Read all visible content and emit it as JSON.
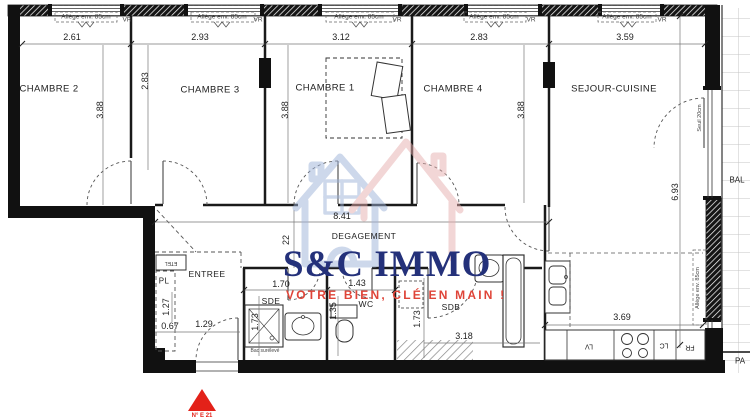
{
  "plan": {
    "window_label": "Allège env. 85cm",
    "vr": "VR",
    "rooms": {
      "ch2": "CHAMBRE 2",
      "ch3": "CHAMBRE 3",
      "ch1": "CHAMBRE 1",
      "ch4": "CHAMBRE 4",
      "sejour": "SEJOUR-CUISINE",
      "degagement": "DEGAGEMENT",
      "entree": "ENTREE",
      "sde": "SDE",
      "wc": "WC",
      "sdb": "SDB",
      "pl": "PL",
      "etel": "ETEL",
      "bal": "BAL",
      "pa": "PA"
    },
    "dims": {
      "w_ch2": "2.61",
      "w_ch3": "2.93",
      "w_ch1": "3.12",
      "w_ch4": "2.83",
      "w_sejour": "3.59",
      "d_ch2": "3.88",
      "d_ch3": "2.83",
      "d_ch1": "3.88",
      "d_ch4": "3.88",
      "h_sejour": "6.93",
      "corridor": "8.41",
      "corridor_w": "22",
      "sde_w": "1.70",
      "sde_d": "1.73",
      "wc_w": "1.43",
      "wc_d": "1.35",
      "sdb_d": "1.73",
      "sdb_w": "3.18",
      "kitchen": "3.69",
      "ent_a": "1.27",
      "ent_b": "0.67",
      "ent_c": "1.29"
    },
    "notes": {
      "seuil": "Seuil 20cm",
      "allege_right": "Allège env. 85cm",
      "bac": "Bac surélevé"
    },
    "appliances": {
      "lv": "LV",
      "lc": "LC",
      "fr": "FR"
    },
    "watermark": {
      "brand": "S&C IMMO",
      "tagline": "VOTRE BIEN, CLÉ EN MAIN !",
      "brand_color": "#24317a",
      "tagline_color": "#df4438"
    },
    "marker": {
      "label": "N° E 21",
      "color": "#e32119"
    }
  }
}
